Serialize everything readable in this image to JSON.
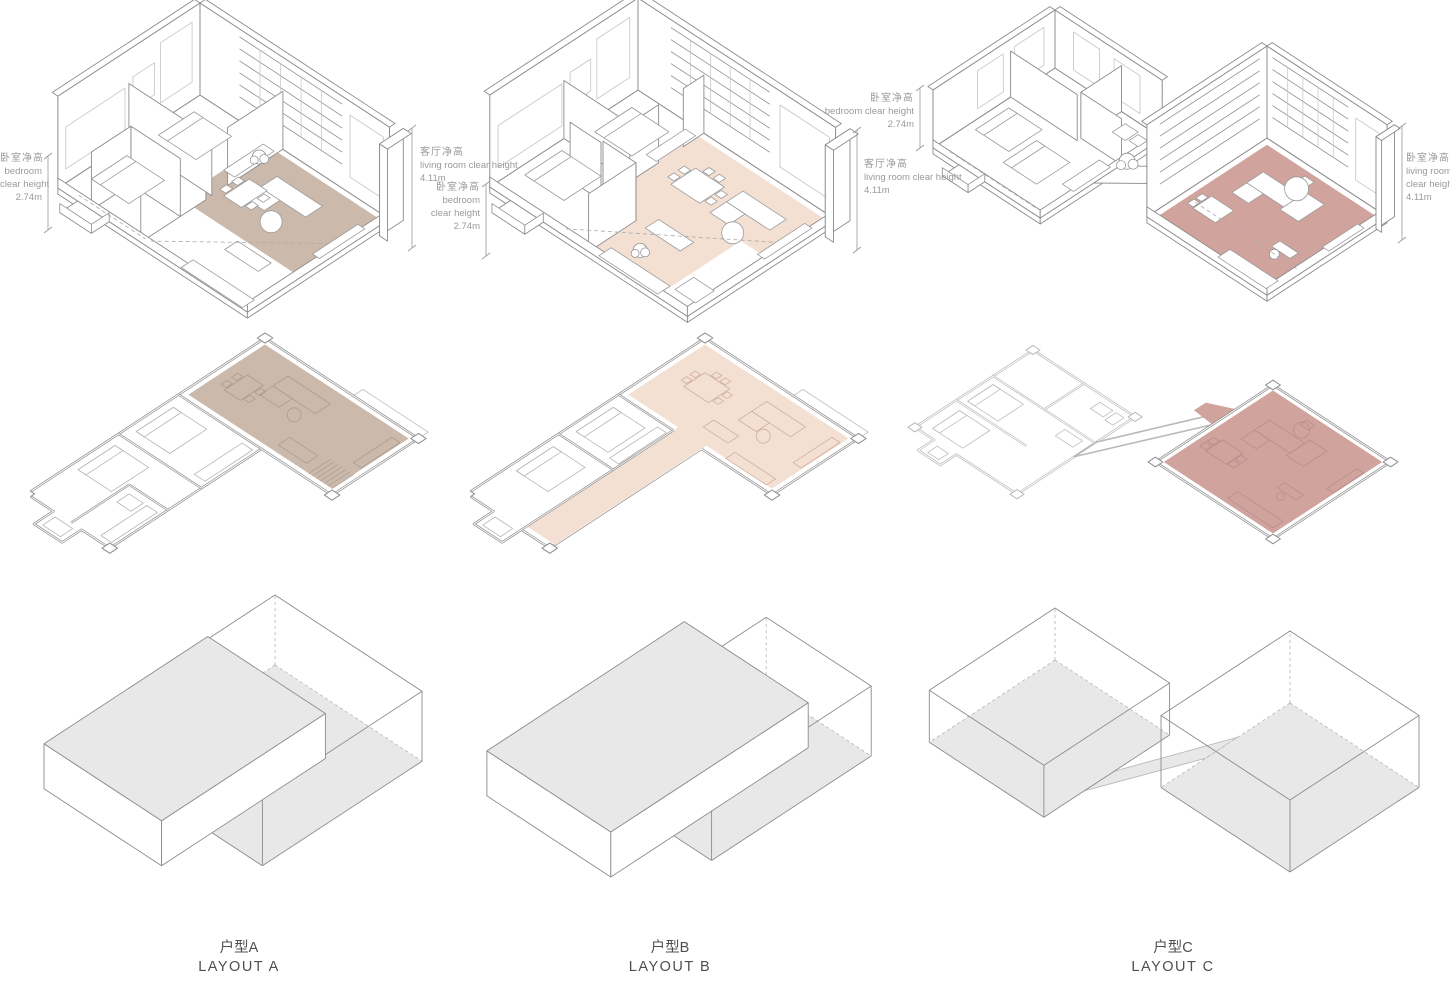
{
  "sheet": {
    "background": "#ffffff"
  },
  "layouts": [
    {
      "label_cn": "户型A",
      "label_en": "LAYOUT A"
    },
    {
      "label_cn": "户型B",
      "label_en": "LAYOUT B"
    },
    {
      "label_cn": "户型C",
      "label_en": "LAYOUT C"
    }
  ],
  "annotations": {
    "a_bedroom": {
      "cn": "卧室净高",
      "lines": [
        "bedroom",
        "clear height"
      ],
      "value": "2.74m"
    },
    "a_living": {
      "cn": "客厅净高",
      "lines": [
        "living room clear height"
      ],
      "value": "4.11m"
    },
    "b_bedroom": {
      "cn": "卧室净高",
      "lines": [
        "bedroom",
        "clear height"
      ],
      "value": "2.74m"
    },
    "b_living": {
      "cn": "客厅净高",
      "lines": [
        "living room clear height"
      ],
      "value": "4.11m"
    },
    "c_bedroom": {
      "cn": "卧室净高",
      "lines": [
        "bedroom clear height"
      ],
      "value": "2.74m"
    },
    "c_living": {
      "cn": "卧室净高",
      "lines": [
        "living room",
        "clear height"
      ],
      "value": "4.11m"
    }
  },
  "colors": {
    "highlight_a": "#cbb9ac",
    "highlight_b": "#f4dfd3",
    "highlight_c": "#d1a39d",
    "massing_fill": "#e8e8e8",
    "line_dark": "#8c8c8c",
    "line_light": "#c4c4c4",
    "annotation_text": "#9a9a9a",
    "label_text": "#4f4f4f"
  }
}
